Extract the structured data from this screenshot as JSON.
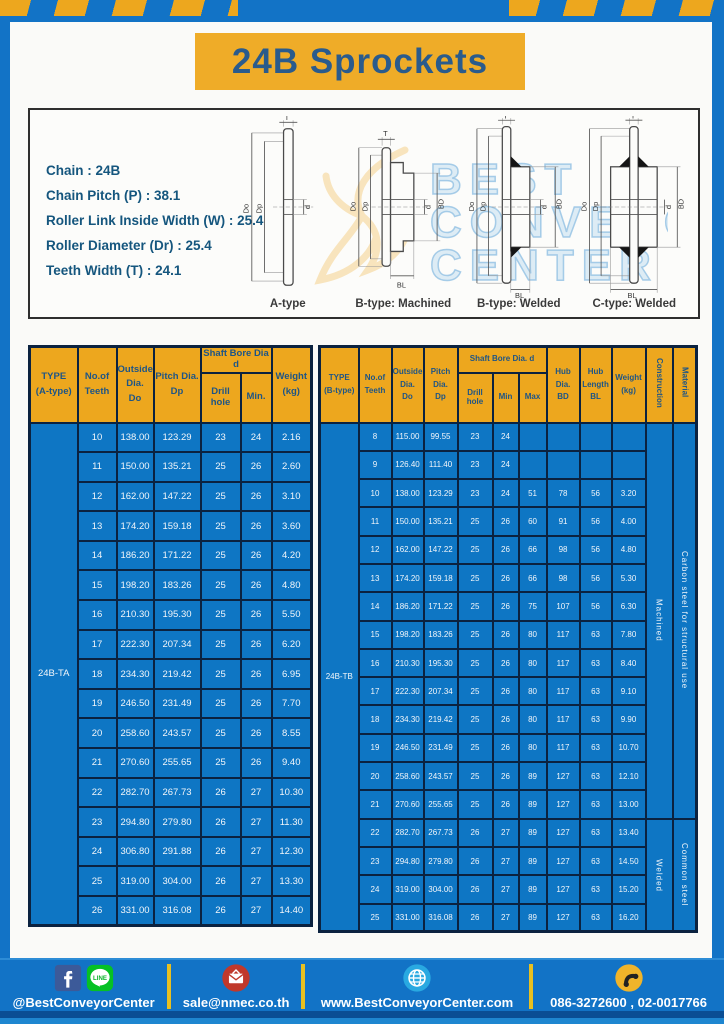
{
  "title": "24B Sprockets",
  "colors": {
    "accent_yellow": "#EDA71E",
    "banner_yellow": "#EFAC28",
    "page_blue": "#1273C6",
    "table_body_blue": "#0E76C4",
    "header_text_navy": "#1E5586",
    "table_border_navy": "#0B2240"
  },
  "specs": {
    "lines": [
      "Chain : 24B",
      "Chain Pitch (P) : 38.1",
      "Roller Link Inside Width (W) : 25.4",
      "Roller Diameter (Dr) : 25.4",
      "Teeth Width (T) : 24.1"
    ]
  },
  "diagram": {
    "captions": [
      "A-type",
      "B-type: Machined",
      "B-type: Welded",
      "C-type: Welded"
    ],
    "dims": {
      "t": "T",
      "outside": "Do",
      "pitch": "Dp",
      "bore": "d",
      "hub_dia": "BD",
      "hub_len": "BL"
    },
    "watermark": [
      "BEST",
      "CONVEYOR",
      "CENTER"
    ]
  },
  "table_a": {
    "type_label": "24B-TA",
    "headers": {
      "type": "TYPE\n(A-type)",
      "teeth": "No.of\nTeeth",
      "outside": "Outside\nDia.\nDo",
      "pitch": "Pitch Dia.\nDp",
      "shaft_bore": "Shaft Bore Dia d",
      "drill": "Drill hole",
      "min": "Min.",
      "weight": "Weight\n(kg)"
    },
    "rows": [
      [
        "10",
        "138.00",
        "123.29",
        "23",
        "24",
        "2.16"
      ],
      [
        "11",
        "150.00",
        "135.21",
        "25",
        "26",
        "2.60"
      ],
      [
        "12",
        "162.00",
        "147.22",
        "25",
        "26",
        "3.10"
      ],
      [
        "13",
        "174.20",
        "159.18",
        "25",
        "26",
        "3.60"
      ],
      [
        "14",
        "186.20",
        "171.22",
        "25",
        "26",
        "4.20"
      ],
      [
        "15",
        "198.20",
        "183.26",
        "25",
        "26",
        "4.80"
      ],
      [
        "16",
        "210.30",
        "195.30",
        "25",
        "26",
        "5.50"
      ],
      [
        "17",
        "222.30",
        "207.34",
        "25",
        "26",
        "6.20"
      ],
      [
        "18",
        "234.30",
        "219.42",
        "25",
        "26",
        "6.95"
      ],
      [
        "19",
        "246.50",
        "231.49",
        "25",
        "26",
        "7.70"
      ],
      [
        "20",
        "258.60",
        "243.57",
        "25",
        "26",
        "8.55"
      ],
      [
        "21",
        "270.60",
        "255.65",
        "25",
        "26",
        "9.40"
      ],
      [
        "22",
        "282.70",
        "267.73",
        "26",
        "27",
        "10.30"
      ],
      [
        "23",
        "294.80",
        "279.80",
        "26",
        "27",
        "11.30"
      ],
      [
        "24",
        "306.80",
        "291.88",
        "26",
        "27",
        "12.30"
      ],
      [
        "25",
        "319.00",
        "304.00",
        "26",
        "27",
        "13.30"
      ],
      [
        "26",
        "331.00",
        "316.08",
        "26",
        "27",
        "14.40"
      ]
    ]
  },
  "table_b": {
    "type_label": "24B-TB",
    "headers": {
      "type": "TYPE\n(B-type)",
      "teeth": "No.of\nTeeth",
      "outside": "Outside\nDia.\nDo",
      "pitch": "Pitch\nDia.\nDp",
      "shaft_bore": "Shaft Bore Dia.  d",
      "drill": "Drill hole",
      "min": "Min",
      "max": "Max",
      "hub_dia": "Hub\nDia.\nBD",
      "hub_len": "Hub\nLength\nBL",
      "weight": "Weight\n(kg)",
      "construction": "Construction",
      "material": "Material"
    },
    "rows": [
      [
        "8",
        "115.00",
        "99.55",
        "23",
        "24",
        "",
        "",
        "",
        ""
      ],
      [
        "9",
        "126.40",
        "111.40",
        "23",
        "24",
        "",
        "",
        "",
        ""
      ],
      [
        "10",
        "138.00",
        "123.29",
        "23",
        "24",
        "51",
        "78",
        "56",
        "3.20"
      ],
      [
        "11",
        "150.00",
        "135.21",
        "25",
        "26",
        "60",
        "91",
        "56",
        "4.00"
      ],
      [
        "12",
        "162.00",
        "147.22",
        "25",
        "26",
        "66",
        "98",
        "56",
        "4.80"
      ],
      [
        "13",
        "174.20",
        "159.18",
        "25",
        "26",
        "66",
        "98",
        "56",
        "5.30"
      ],
      [
        "14",
        "186.20",
        "171.22",
        "25",
        "26",
        "75",
        "107",
        "56",
        "6.30"
      ],
      [
        "15",
        "198.20",
        "183.26",
        "25",
        "26",
        "80",
        "117",
        "63",
        "7.80"
      ],
      [
        "16",
        "210.30",
        "195.30",
        "25",
        "26",
        "80",
        "117",
        "63",
        "8.40"
      ],
      [
        "17",
        "222.30",
        "207.34",
        "25",
        "26",
        "80",
        "117",
        "63",
        "9.10"
      ],
      [
        "18",
        "234.30",
        "219.42",
        "25",
        "26",
        "80",
        "117",
        "63",
        "9.90"
      ],
      [
        "19",
        "246.50",
        "231.49",
        "25",
        "26",
        "80",
        "117",
        "63",
        "10.70"
      ],
      [
        "20",
        "258.60",
        "243.57",
        "25",
        "26",
        "89",
        "127",
        "63",
        "12.10"
      ],
      [
        "21",
        "270.60",
        "255.65",
        "25",
        "26",
        "89",
        "127",
        "63",
        "13.00"
      ],
      [
        "22",
        "282.70",
        "267.73",
        "26",
        "27",
        "89",
        "127",
        "63",
        "13.40"
      ],
      [
        "23",
        "294.80",
        "279.80",
        "26",
        "27",
        "89",
        "127",
        "63",
        "14.50"
      ],
      [
        "24",
        "319.00",
        "304.00",
        "26",
        "27",
        "89",
        "127",
        "63",
        "15.20"
      ],
      [
        "25",
        "331.00",
        "316.08",
        "26",
        "27",
        "89",
        "127",
        "63",
        "16.20"
      ]
    ],
    "construction_groups": [
      {
        "label": "Machined",
        "rows": 14
      },
      {
        "label": "Welded",
        "rows": 4
      }
    ],
    "material_groups": [
      {
        "label": "Carbon steel for structural use",
        "rows": 14
      },
      {
        "label": "Common steel",
        "rows": 4
      }
    ]
  },
  "footer": {
    "social_handle": "@BestConveyorCenter",
    "line_label": "LINE",
    "email": "sale@nmec.co.th",
    "website": "www.BestConveyorCenter.com",
    "phone": "086-3272600 , 02-0017766"
  }
}
